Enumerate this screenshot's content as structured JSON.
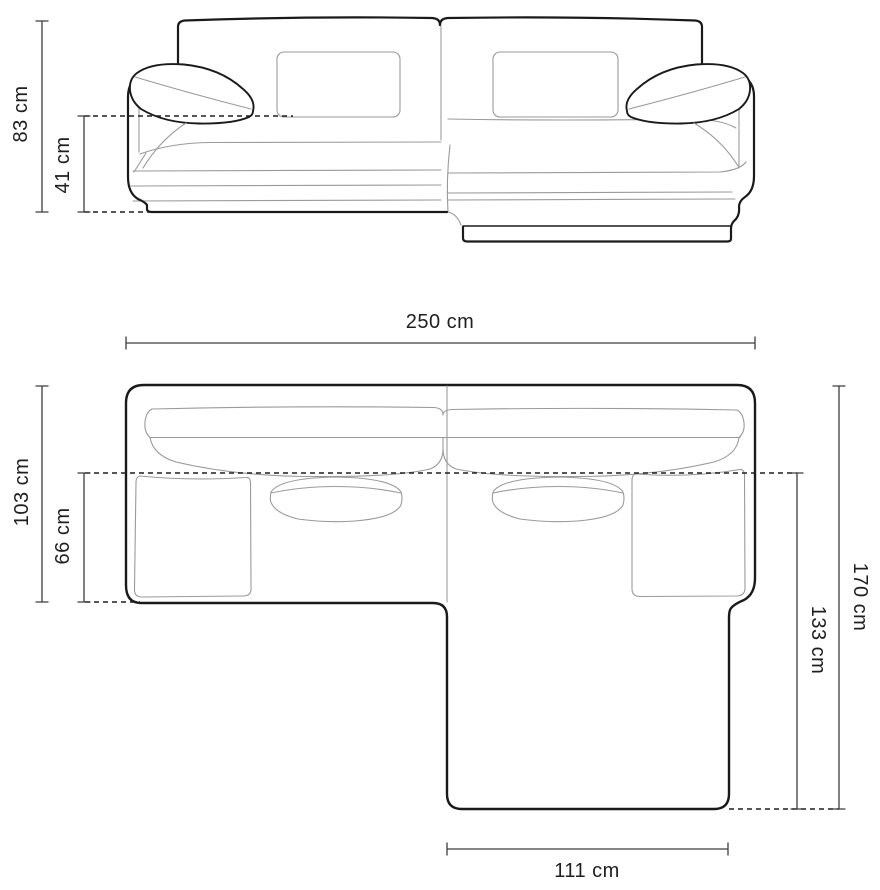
{
  "diagram": {
    "dimensions": {
      "front_view": {
        "total_height": "83 cm",
        "seat_height": "41 cm"
      },
      "top_view": {
        "total_width": "250 cm",
        "left_depth_total": "103 cm",
        "left_seat_depth": "66 cm",
        "right_depth_total": "170 cm",
        "chaise_extension_depth": "133 cm",
        "chaise_width": "111 cm"
      }
    },
    "colors": {
      "outline": "#1a1a1a",
      "detail_line": "#9a9a9a",
      "dimension_line": "#3d3d3d",
      "label_text": "#1f1f1f",
      "background": "#ffffff"
    }
  }
}
